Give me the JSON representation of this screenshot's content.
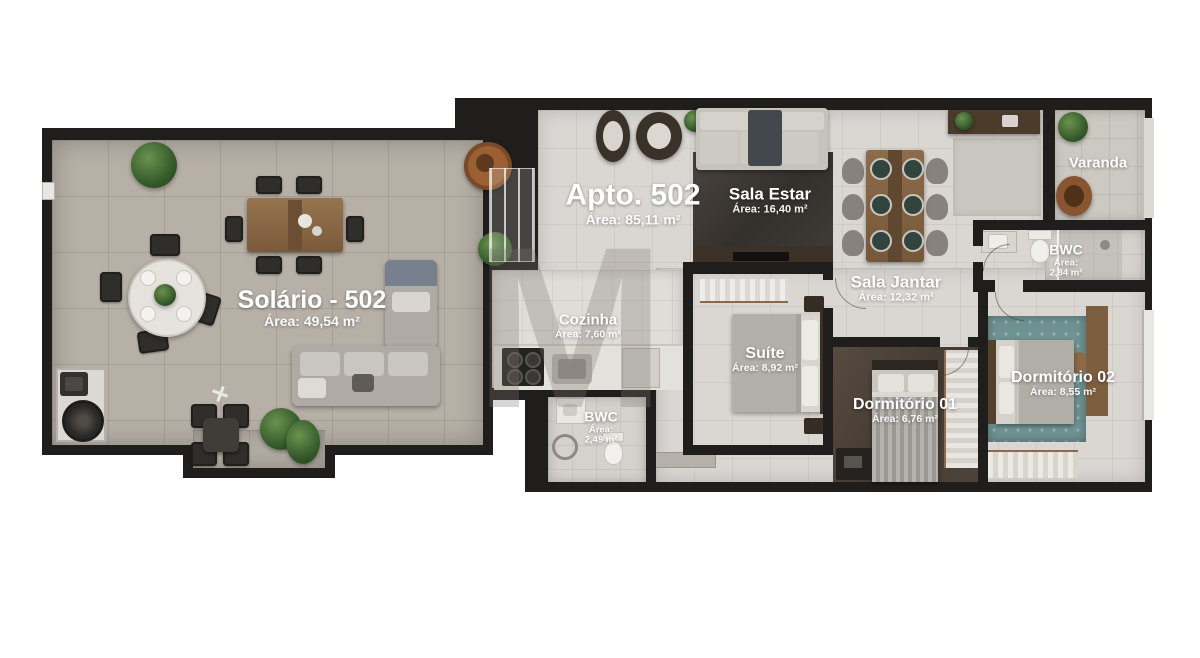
{
  "unit": {
    "name": "Apto. 502",
    "area": "Área: 85,11 m²"
  },
  "rooms": {
    "solario": {
      "name": "Solário - 502",
      "area": "Área: 49,54 m²"
    },
    "sala_estar": {
      "name": "Sala Estar",
      "area": "Área: 16,40 m²"
    },
    "sala_jantar": {
      "name": "Sala Jantar",
      "area": "Área: 12,32 m²"
    },
    "cozinha": {
      "name": "Cozinha",
      "area": "Área: 7,60 m²"
    },
    "suite": {
      "name": "Suíte",
      "area": "Área: 8,92 m²"
    },
    "dormitorio_01": {
      "name": "Dormitório 01",
      "area": "Área: 6,76 m²"
    },
    "dormitorio_02": {
      "name": "Dormitório 02",
      "area": "Área: 8,55 m²"
    },
    "bwc_social": {
      "name": "BWC",
      "area_label": "Área:",
      "area_value": "2,84 m²"
    },
    "bwc_servico": {
      "name": "BWC",
      "area_label": "Área:",
      "area_value": "2,49 m²"
    },
    "varanda": {
      "name": "Varanda"
    }
  },
  "watermark": {
    "letter": "M"
  },
  "colors": {
    "wall": "#201e1c",
    "terrace_floor": "#b6b0a7",
    "interior_floor": "#dad7d3",
    "dark_floor": "#3f3b37",
    "teal_rug": "#6f9292",
    "wood": "#8a6b4e"
  }
}
